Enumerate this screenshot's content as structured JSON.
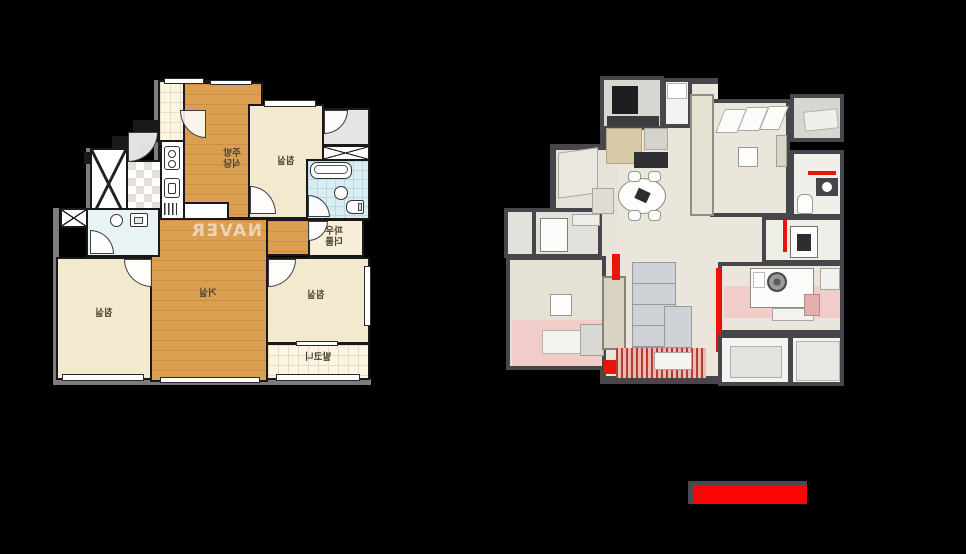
{
  "background_color": "#000000",
  "left_plan": {
    "watermark": "NAVER",
    "mirrored": true,
    "labels": {
      "kitchen_l1": "주방",
      "kitchen_l2": "식당",
      "bedroom_top": "침실",
      "bedroom_left": "침실",
      "bedroom_right": "침실",
      "living": "거실",
      "powder_l1": "파우",
      "powder_l2": "더룸",
      "balcony": "발코니"
    },
    "colors": {
      "wood_floor": "#db9f52",
      "room_cream": "#f3e9cf",
      "balcony_tile": "#fbf5e3",
      "bath_blue": "#d9edf2",
      "wall": "#191919",
      "outer_shadow": "#7d7d7d"
    }
  },
  "right_plan": {
    "colors": {
      "wall": "#47474b",
      "floor_beige": "#eae6db",
      "floor_gray": "#d8d6d1",
      "carpet_pink": "#f0cdc9",
      "accent_red": "#e8150d",
      "sofa_gray": "#ced1d5"
    }
  },
  "highlight_bar": {
    "fill": "#fa0505",
    "border": "#4a4a4a"
  }
}
